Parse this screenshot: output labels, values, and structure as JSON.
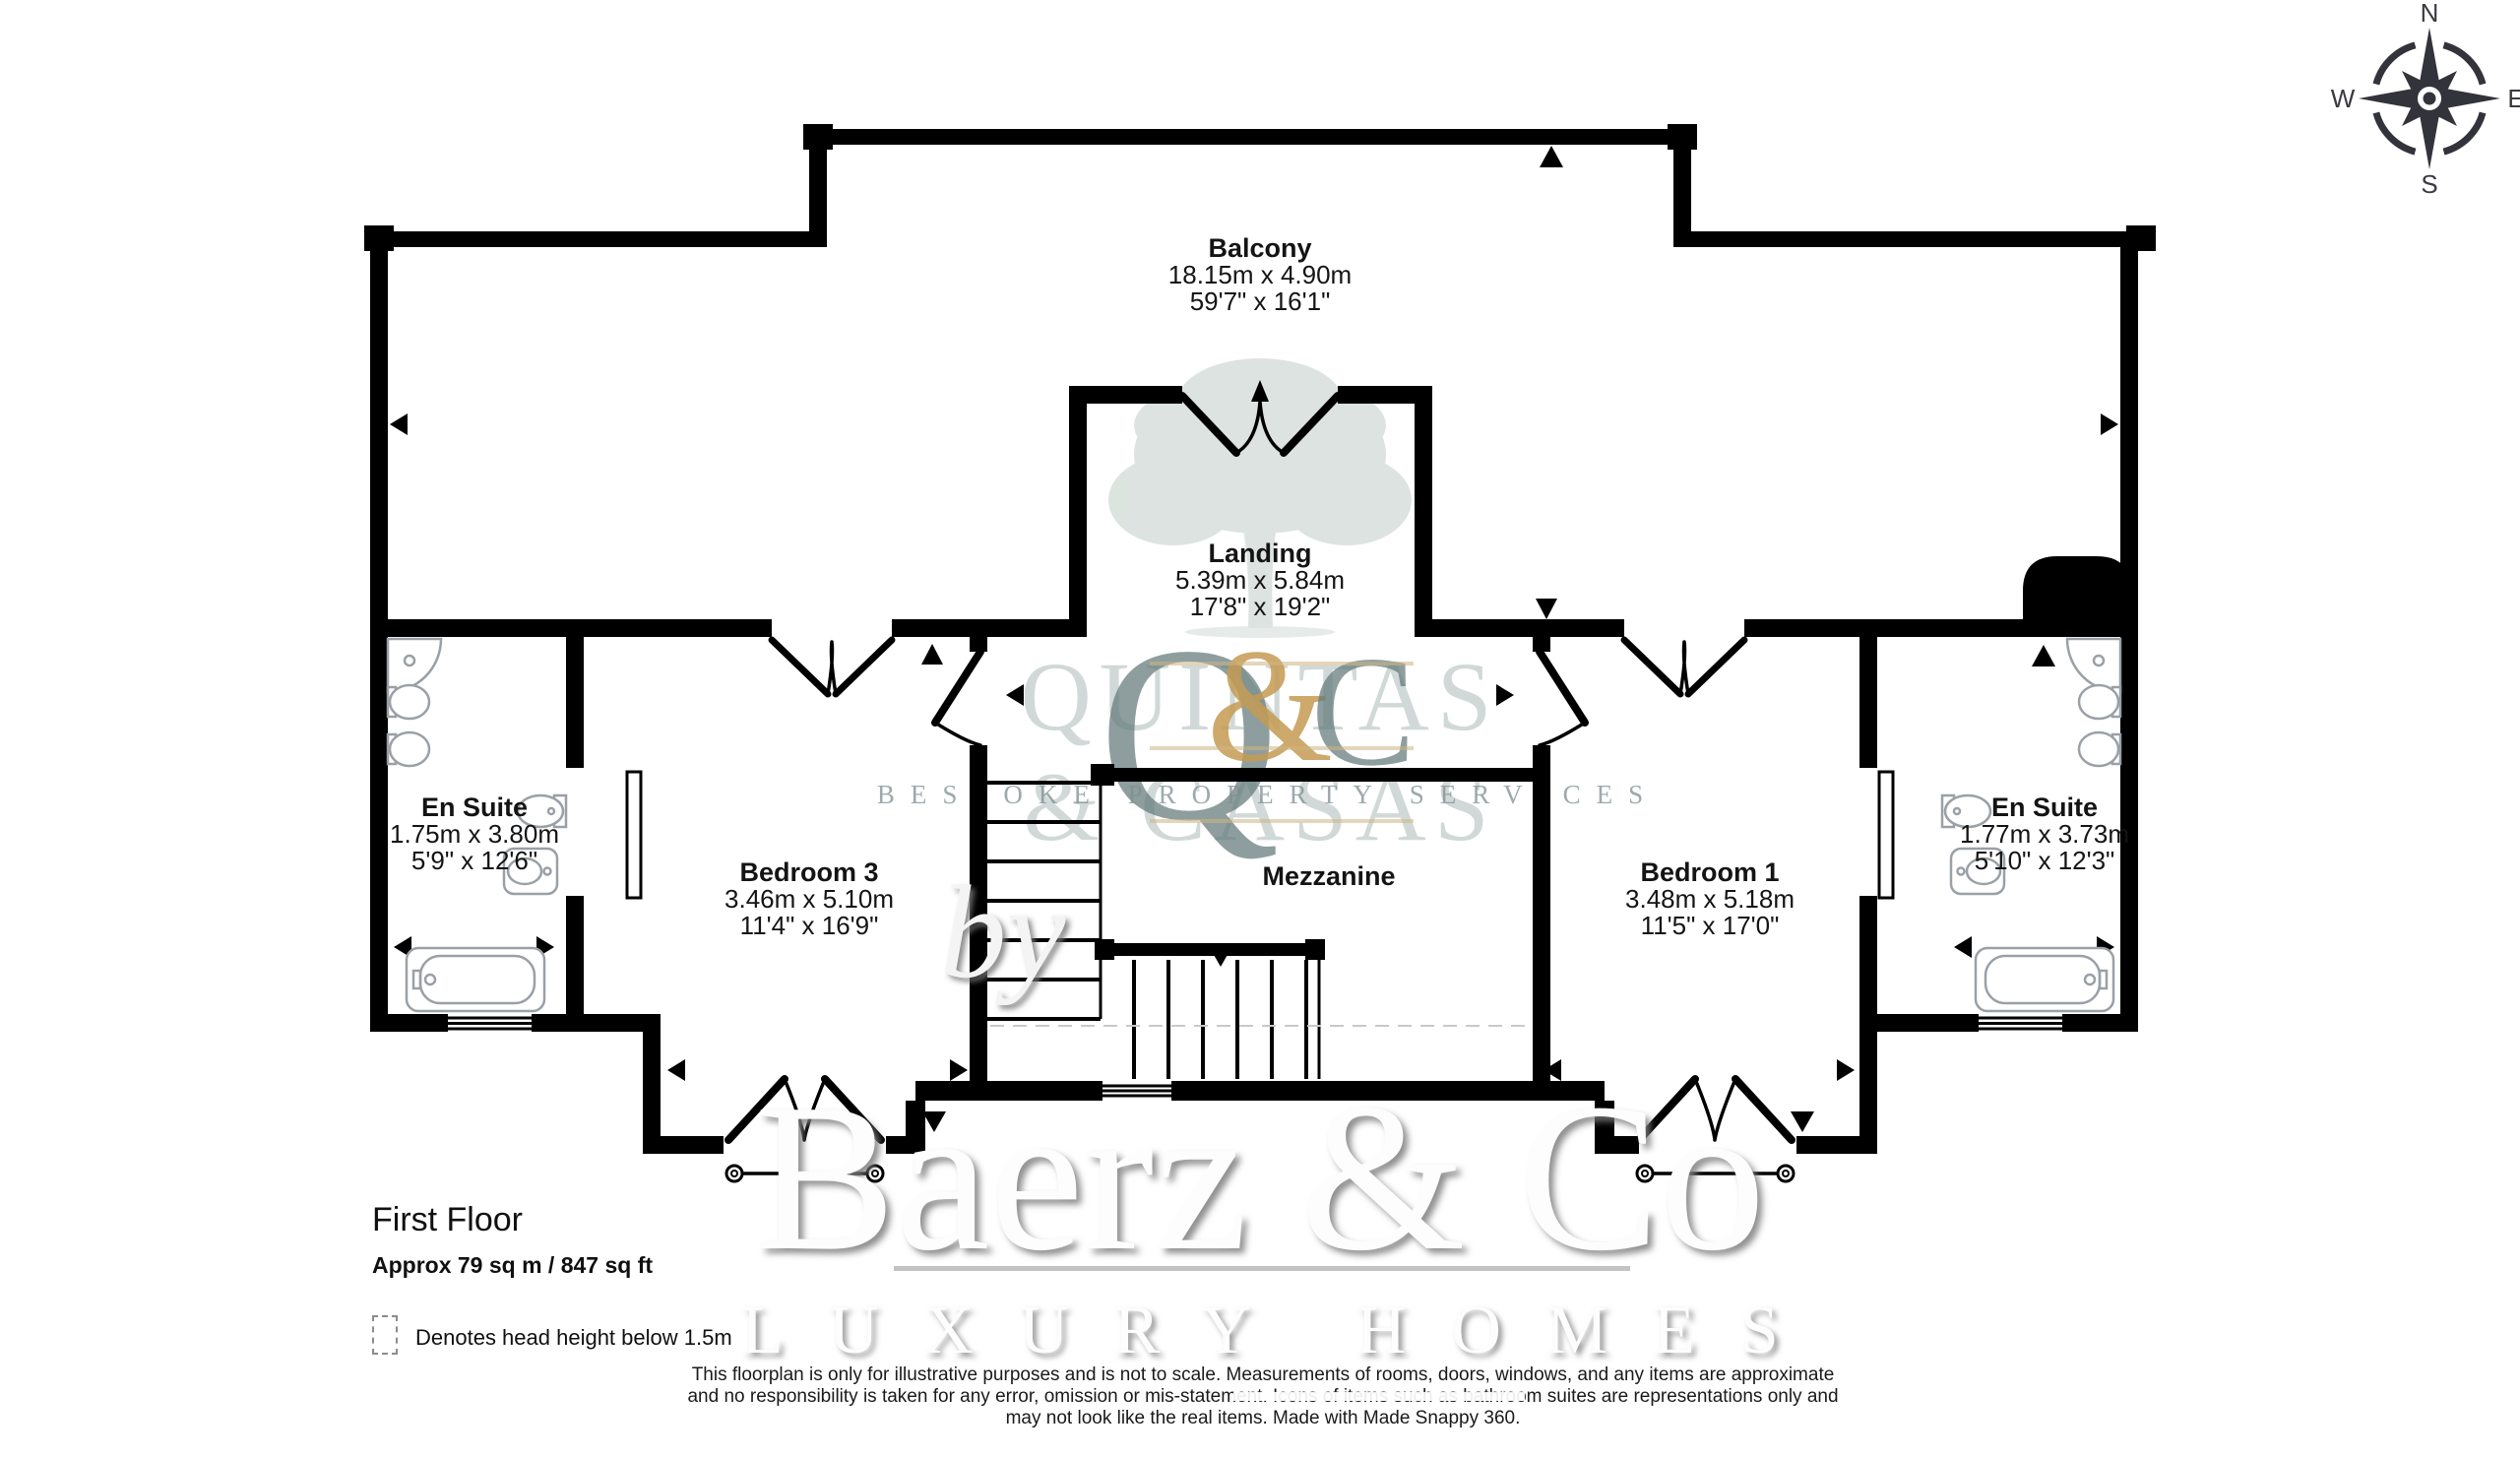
{
  "compass": {
    "n": "N",
    "e": "E",
    "s": "S",
    "w": "W"
  },
  "rooms": {
    "balcony": {
      "name": "Balcony",
      "metric": "18.15m x 4.90m",
      "imperial": "59'7\" x 16'1\""
    },
    "landing": {
      "name": "Landing",
      "metric": "5.39m x 5.84m",
      "imperial": "17'8\" x 19'2\""
    },
    "ensuite_left": {
      "name": "En Suite",
      "metric": "1.75m x 3.80m",
      "imperial": "5'9\" x 12'6\""
    },
    "bedroom3": {
      "name": "Bedroom 3",
      "metric": "3.46m x 5.10m",
      "imperial": "11'4\" x 16'9\""
    },
    "mezzanine": {
      "name": "Mezzanine"
    },
    "bedroom1": {
      "name": "Bedroom 1",
      "metric": "3.48m x 5.18m",
      "imperial": "11'5\" x 17'0\""
    },
    "ensuite_right": {
      "name": "En Suite",
      "metric": "1.77m x 3.73m",
      "imperial": "5'10\" x 12'3\""
    }
  },
  "footer": {
    "floor_title": "First Floor",
    "area": "Approx 79 sq m / 847 sq ft",
    "legend": "Denotes head height below 1.5m",
    "disclaimer": [
      "This floorplan is only for illustrative purposes and is not to scale. Measurements of rooms, doors, windows, and any items are approximate",
      "and no responsibility is taken for any error, omission or mis-statement. Icons of items such as bathroom suites are representations only and",
      "may not look like the real items. Made with Made Snappy 360."
    ]
  },
  "watermarks": {
    "agency_top": "QUINTAS",
    "agency_bottom": "& CASAS",
    "monogram_q": "Q",
    "monogram_amp": "&",
    "monogram_c": "C",
    "tagline": "BESPOKE PROPERTY SERVICES",
    "by": "by",
    "brand": "Baerz & Co",
    "brand_tagline": "LUXURY HOMES"
  },
  "colors": {
    "wall": "#000000",
    "fixture_outline": "#9aa0a6",
    "tree": "#c5d2cc",
    "gold": "#c49a52",
    "slate": "#6b8083",
    "compass": "#33333b"
  }
}
